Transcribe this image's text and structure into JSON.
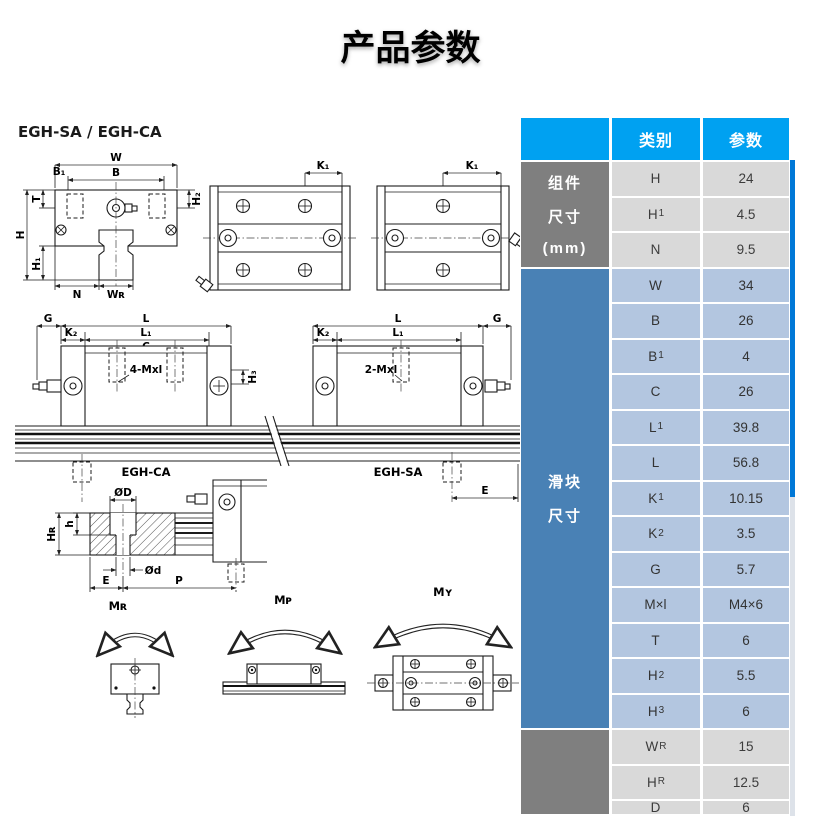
{
  "page": {
    "title": "产品参数"
  },
  "drawing": {
    "model": "EGH-SA / EGH-CA",
    "labels": {
      "w": "W",
      "b": "B",
      "b1": "B₁",
      "t": "T",
      "h": "H",
      "h1": "H₁",
      "h2": "H₂",
      "n": "N",
      "wr": "Wʀ",
      "k1": "K₁",
      "g": "G",
      "l": "L",
      "k2": "K₂",
      "l1": "L₁",
      "c": "C",
      "mxl4": "4-Mxl",
      "mxl2": "2-Mxl",
      "h3": "H₃",
      "egh_ca": "EGH-CA",
      "egh_sa": "EGH-SA",
      "e": "E",
      "od": "ØD",
      "h_depth": "h",
      "hr": "Hʀ",
      "od_small": "Ød",
      "p": "P",
      "mr": "Mʀ",
      "mp": "Mᴘ",
      "my": "Mʏ"
    }
  },
  "table": {
    "header": {
      "category": "类别",
      "parameter": "参数"
    },
    "groups": [
      {
        "label": [
          "组件",
          "尺寸",
          "(mm)"
        ],
        "rows": [
          {
            "name": "H",
            "sub": "",
            "value": "24"
          },
          {
            "name": "H",
            "sub": "1",
            "value": "4.5"
          },
          {
            "name": "N",
            "sub": "",
            "value": "9.5"
          }
        ]
      },
      {
        "label": [
          "滑块",
          "尺寸"
        ],
        "rows": [
          {
            "name": "W",
            "sub": "",
            "value": "34"
          },
          {
            "name": "B",
            "sub": "",
            "value": "26"
          },
          {
            "name": "B",
            "sub": "1",
            "value": "4"
          },
          {
            "name": "C",
            "sub": "",
            "value": "26"
          },
          {
            "name": "L",
            "sub": "1",
            "value": "39.8"
          },
          {
            "name": "L",
            "sub": "",
            "value": "56.8"
          },
          {
            "name": "K",
            "sub": "1",
            "value": "10.15"
          },
          {
            "name": "K",
            "sub": "2",
            "value": "3.5"
          },
          {
            "name": "G",
            "sub": "",
            "value": "5.7"
          },
          {
            "name": "M×l",
            "sub": "",
            "value": "M4×6"
          },
          {
            "name": "T",
            "sub": "",
            "value": "6"
          },
          {
            "name": "H",
            "sub": "2",
            "value": "5.5"
          },
          {
            "name": "H",
            "sub": "3",
            "value": "6"
          }
        ]
      },
      {
        "label": [],
        "rows": [
          {
            "name": "W",
            "sub": "R",
            "value": "15"
          },
          {
            "name": "H",
            "sub": "R",
            "value": "12.5"
          },
          {
            "name": "D",
            "sub": "",
            "value": "6"
          }
        ]
      }
    ]
  },
  "colors": {
    "header_blue": "#00a1f1",
    "group_gray": "#7f7f7f",
    "group_steel_blue": "#4981b5",
    "cell_gray": "#d9d9d9",
    "cell_blue": "#b3c6e0",
    "scrollbar_thumb": "#0078d7"
  }
}
